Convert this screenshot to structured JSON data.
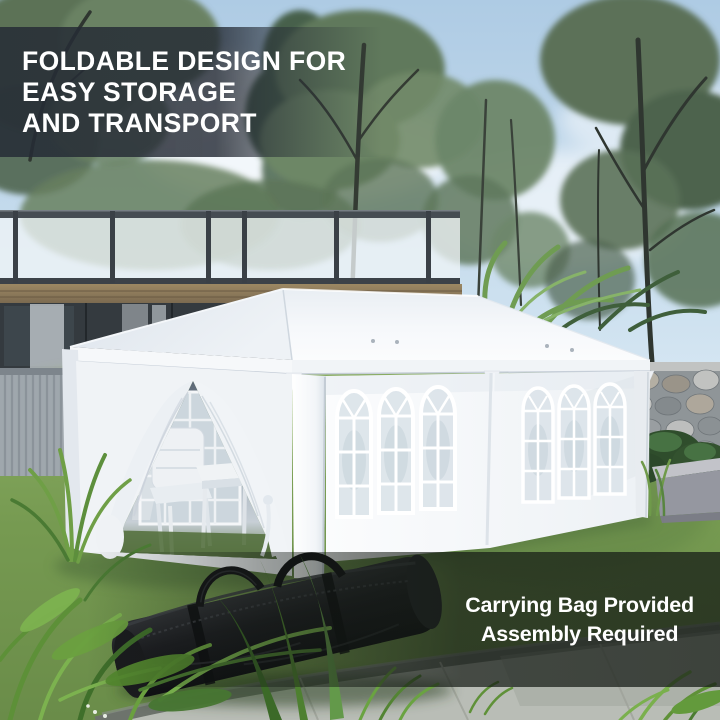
{
  "overlays": {
    "headline": {
      "line1": "FOLDABLE DESIGN FOR",
      "line2": "EASY STORAGE",
      "line3": "AND TRANSPORT"
    },
    "caption": {
      "line1": "Carrying Bag Provided",
      "line2": "Assembly Required"
    }
  },
  "scene": {
    "subject": "white pop-up gazebo party tent with arched-window sidewalls and tied-back door curtains in a garden, black carrying bag on the lawn",
    "objects": [
      "gazebo-tent",
      "carrying-bag",
      "garden-lawn",
      "stone-wall",
      "house-deck-railing",
      "patio-chairs",
      "folding-table",
      "concrete-path",
      "foreground-plants",
      "background-trees"
    ],
    "colors": {
      "tent_white": "#f5f7fa",
      "sky_blue": "#bdd7ea",
      "lawn_green": "#7a9e55",
      "bag_black": "#17181b",
      "stone_gray": "#8f9598",
      "wood_fascia": "#8a7a5e",
      "headline_text": "#ffffff",
      "caption_text": "#ffffff",
      "headline_band": "rgba(37,43,53,0.84)",
      "caption_band": "rgba(20,26,20,0.72)"
    }
  }
}
